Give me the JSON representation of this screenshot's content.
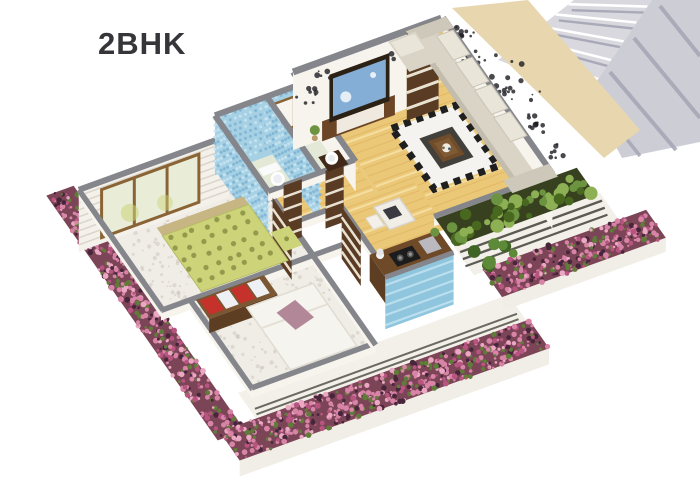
{
  "title": "2BHK",
  "scene": {
    "features": [
      "staircase",
      "exterior-passage",
      "living-room",
      "tv-unit",
      "entry-door",
      "sofa",
      "zigzag-rug",
      "coffee-table",
      "bathroom-1",
      "bathroom-2",
      "master-bedroom",
      "sliding-window",
      "bedroom-2",
      "dresser",
      "kitchen",
      "gas-stove",
      "blue-backsplash",
      "balcony-planter",
      "railing",
      "flower-borders",
      "dining-table"
    ]
  },
  "palette": {
    "wood": "#ebc878",
    "wood_dark": "#d7a854",
    "wood_light": "#f7e3a8",
    "marble": "#f0ede7",
    "marble_dot": "#c9c4ba",
    "bath_floor": "#e3e9d6",
    "tile_base": "#a6d0e4",
    "tile_dark": "#7cb3d2",
    "tile_mid": "#c9e5f2",
    "wall_top": "#85868b",
    "wall_face": "#f7f4ee",
    "sofa": "#d9d4c6",
    "sofa_back": "#e9e5d9",
    "sofa_arm": "#cdc8b9",
    "sofa_edge": "#c2bdae",
    "bed_green": "#ccd378",
    "bed_dot": "#8d9447",
    "headboard": "#c7b684",
    "rug_white": "#f5f3ef",
    "rug_black": "#1f1f1f",
    "rug_center": "#42403a",
    "table": "#704c2a",
    "table_top": "#7e5a35",
    "tv_unit": "#6b4526",
    "tv_frame": "#2b2114",
    "tv_screen": "#85aed6",
    "door": "#5a3c24",
    "door_slat": "#e9e1d1",
    "soil": "#37411f",
    "foliage1": "#6c9440",
    "foliage2": "#8eb054",
    "foliage3": "#49681f",
    "flower_base": "#7c4457",
    "flower_pink1": "#d884a6",
    "flower_pink2": "#b85480",
    "flower_pink3": "#eaa8c2",
    "flower_leaf": "#5f7c38",
    "flower_dark": "#47253a",
    "stair": "#d8d8de",
    "stair2": "#cdcdd6",
    "stair_stripe": "#a5a5b4",
    "beige": "#e7d6ae",
    "decal": "#1c1c20",
    "counter": "#6f4a28",
    "counter_side": "#5d3e22",
    "splash": "#8fc6de",
    "splash_line": "#c6e6f2",
    "glass": "#e9edd8",
    "frame": "#8a6435",
    "dresser": "#7a5632",
    "box_red": "#c5312b",
    "box_white": "#eef0f4",
    "mauve": "#b28797",
    "bed2": "#f6f4ef",
    "railing": "#5b5b54",
    "deck": "#f3f0e9",
    "white_drop": "#f1eee7",
    "text": "#35353a"
  }
}
